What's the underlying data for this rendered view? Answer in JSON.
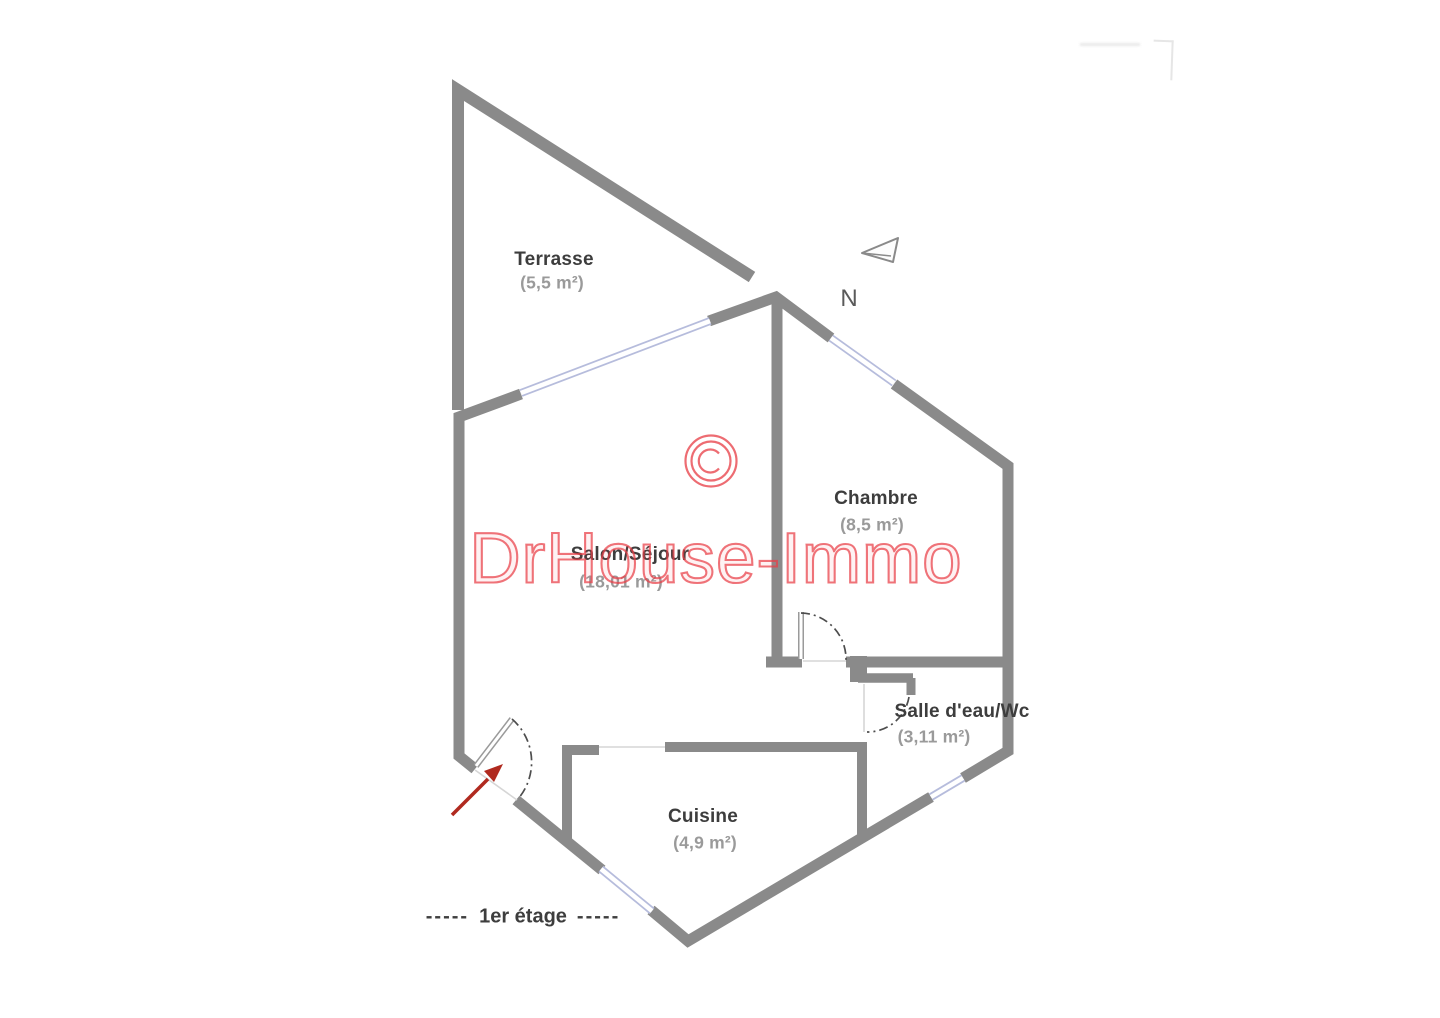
{
  "plan": {
    "watermark": {
      "text": "DrHouse-Immo",
      "symbol": "©",
      "color": "#e9434b"
    },
    "compass": {
      "label": "N"
    },
    "floor": {
      "dashes": "-----",
      "label": "1er étage"
    },
    "rooms": [
      {
        "id": "terrasse",
        "name": "Terrasse",
        "area": "(5,5 m²)"
      },
      {
        "id": "salon",
        "name": "Salon/Séjour",
        "area": "(18,01 m²)"
      },
      {
        "id": "chambre",
        "name": "Chambre",
        "area": "(8,5 m²)"
      },
      {
        "id": "salle-deau",
        "name": "Salle d'eau/Wc",
        "area": "(3,11 m²)"
      },
      {
        "id": "cuisine",
        "name": "Cuisine",
        "area": "(4,9 m²)"
      }
    ],
    "colors": {
      "wall": "#8a8a8a",
      "window": "#b6bcdc",
      "door_swing": "#4d4d4d",
      "entry_arrow": "#b02a1f",
      "room_name": "#3d3d3d",
      "room_area": "#9a9a9a"
    }
  }
}
